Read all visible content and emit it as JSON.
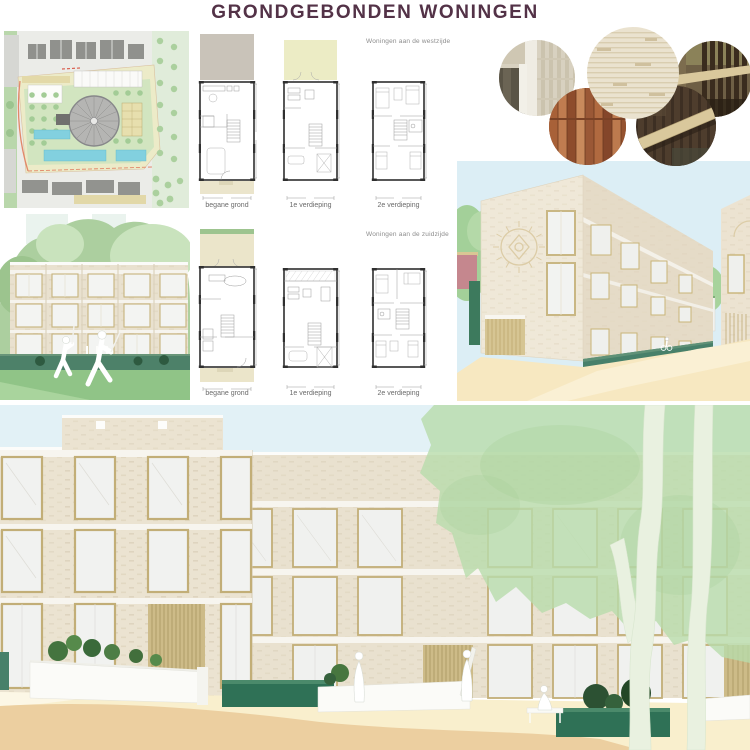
{
  "page": {
    "title": "GRONDGEBONDEN WONINGEN"
  },
  "plan_sections": {
    "west": {
      "label": "Woningen aan de westzijde"
    },
    "zuid": {
      "label": "Woningen aan de zuidzijde"
    },
    "floor_labels": [
      "begane grond",
      "1e verdieping",
      "2e verdieping"
    ]
  },
  "materials": {
    "swatches": [
      {
        "name": "brick-facade-window-detail",
        "color": "#d8d1c0"
      },
      {
        "name": "warm-wood-cladding",
        "color": "#b06a40"
      },
      {
        "name": "cream-brick-texture",
        "color": "#eae2cf"
      },
      {
        "name": "dark-wood-slats-with-beam",
        "color": "#3d2f23"
      },
      {
        "name": "bronze-wood-slat-interior",
        "color": "#6e5f45"
      }
    ]
  },
  "palette": {
    "title_text": "#533247",
    "label_text": "#8c8c8c",
    "facade_brick": "#eae2d0",
    "window_frame": "#c2ae77",
    "hedge_green": "#47806a",
    "lawn_green": "#90c487",
    "tree_canopy": "#b8dcab",
    "sky_blue": "#dcedf4",
    "street_sand": "#f3dfa8",
    "planter_green": "#2f7156",
    "pool_blue": "#82d0df"
  }
}
